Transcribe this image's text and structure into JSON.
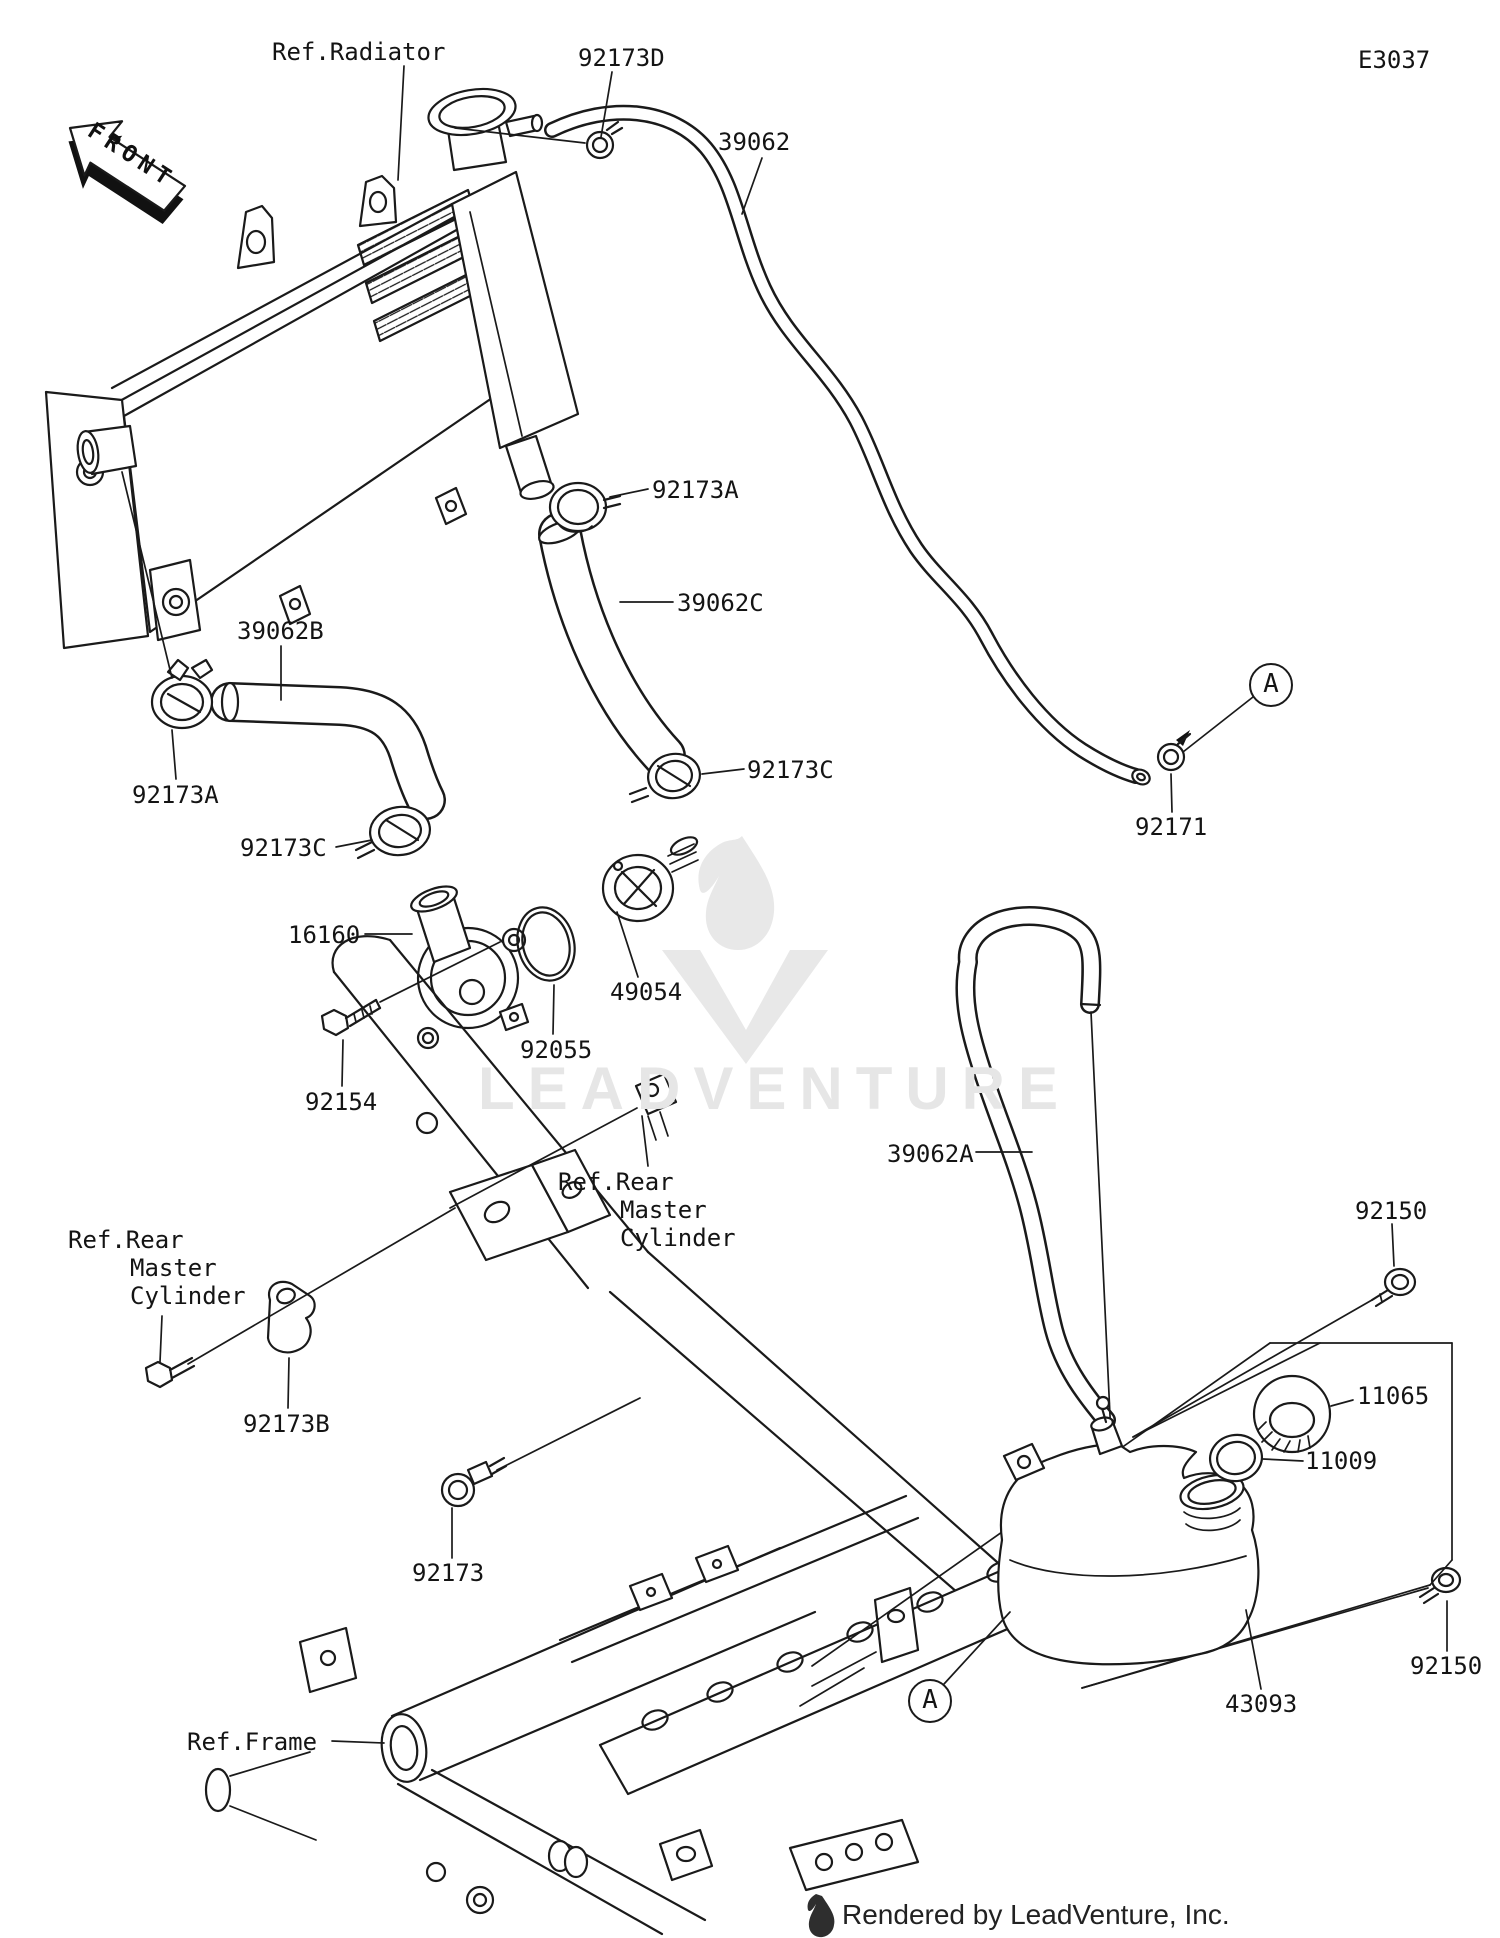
{
  "diagram": {
    "page_code": "E3037",
    "front_label": "FRONT",
    "watermark_text": "LEADVENTURE",
    "credit": "Rendered by LeadVenture, Inc.",
    "detail_marker": "A",
    "references": {
      "radiator": "Ref.Radiator",
      "frame": "Ref.Frame",
      "rear_master_line1": "Ref.Rear",
      "rear_master_line2": "Master",
      "rear_master_line3": "Cylinder"
    },
    "parts": {
      "hose_39062": "39062",
      "hose_39062a": "39062A",
      "hose_39062b": "39062B",
      "hose_39062c": "39062C",
      "clamp_92173": "92173",
      "clamp_92173a": "92173A",
      "clamp_92173b": "92173B",
      "clamp_92173c": "92173C",
      "clamp_92173d": "92173D",
      "clamp_92171": "92171",
      "fitting_16160": "16160",
      "thermostat_49054": "49054",
      "oring_92055": "92055",
      "bolt_92154": "92154",
      "bolt_92150": "92150",
      "cap_11065": "11065",
      "gasket_11009": "11009",
      "reservoir_43093": "43093"
    }
  }
}
